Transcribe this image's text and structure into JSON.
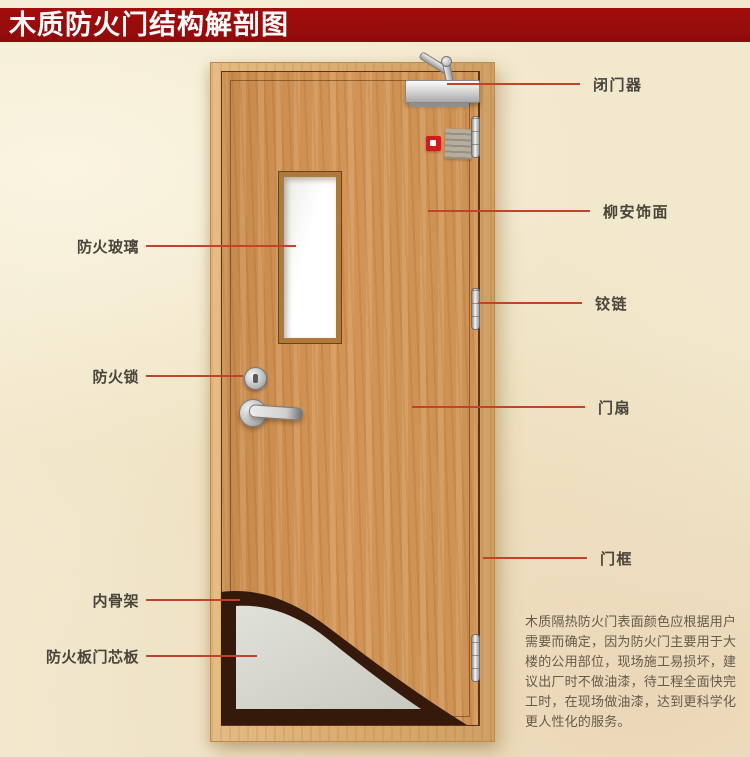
{
  "title": {
    "text": "木质防火门结构解剖图"
  },
  "callouts": {
    "left": [
      {
        "id": "fire-glass",
        "label": "防火玻璃"
      },
      {
        "id": "fire-lock",
        "label": "防火锁"
      },
      {
        "id": "inner-skeleton",
        "label": "内骨架"
      },
      {
        "id": "fire-board-core",
        "label": "防火板门芯板"
      }
    ],
    "right": [
      {
        "id": "door-closer",
        "label": "闭门器"
      },
      {
        "id": "lauan-veneer",
        "label": "柳安饰面"
      },
      {
        "id": "hinge",
        "label": "铰链"
      },
      {
        "id": "door-leaf",
        "label": "门扇"
      },
      {
        "id": "door-frame",
        "label": "门框"
      }
    ]
  },
  "description": {
    "lines": [
      "木质隔热防火门表面颜色应根据用户",
      "需要而确定，因为防火门主要用于大",
      "楼的公用部位，现场施工易损坏，建",
      "议出厂时不做油漆，待工程全面快完",
      "工时，在现场做油漆，达到更科学化",
      "更人性化的服务。"
    ]
  },
  "colors": {
    "banner-red": "#a30d0d",
    "callout-line": "#c2422a",
    "label-text": "#49443c",
    "door-wood": "#cd9254",
    "frame-wood": "#dfb27a",
    "core-gray": "#d9d9d2",
    "skeleton-brown": "#351a0b",
    "background": "#f2e8cd"
  }
}
